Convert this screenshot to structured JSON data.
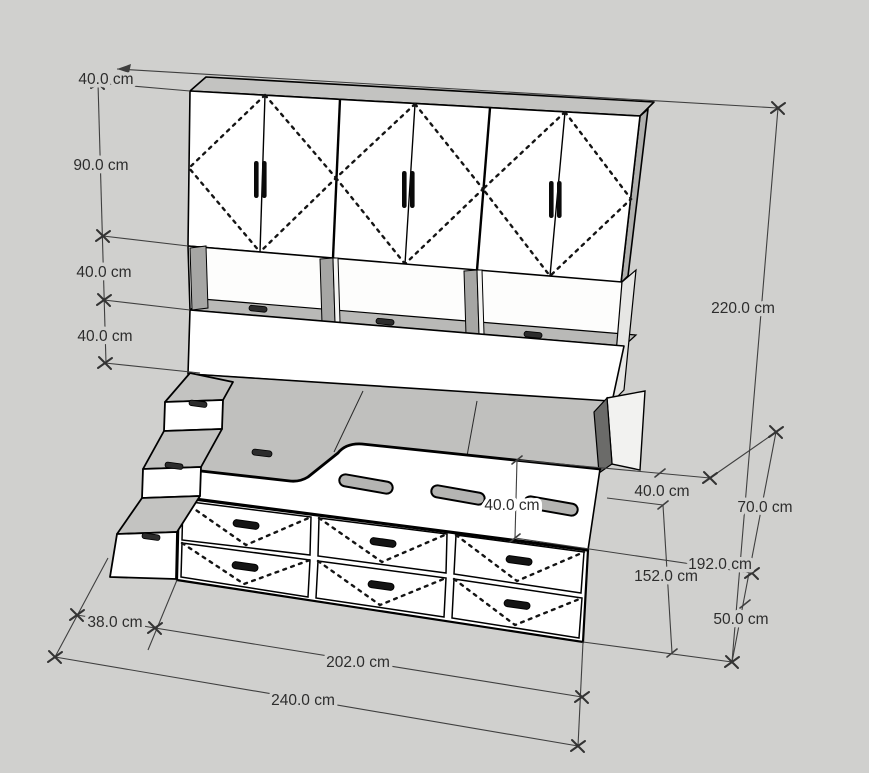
{
  "scene": {
    "description": "isometric CAD-style dimension drawing of a cabin bed with wardrobe, shelves, drawers and stairs",
    "unit": "cm",
    "background_color": "#d0d0ce",
    "face_color": "#ffffff",
    "top_face_color": "#c3c3c1",
    "shadow_color": "#a6a6a4",
    "dark_panel_color": "#6b6b69",
    "line_color": "#000000",
    "dimension_color": "#3f3f3f"
  },
  "dimensions": {
    "top_depth": "40.0 cm",
    "wardrobe_height": "90.0 cm",
    "shelf_row_height": "40.0 cm",
    "headboard_height": "40.0 cm",
    "total_height": "220.0 cm",
    "bed_rail_height": "40.0 cm",
    "bed_end_depth": "40.0 cm",
    "right_height_70": "70.0 cm",
    "bed_length_192": "192.0 cm",
    "bed_length_152": "152.0 cm",
    "right_height_50": "50.0 cm",
    "stairs_width": "38.0 cm",
    "drawers_length": "202.0 cm",
    "total_length": "240.0 cm"
  },
  "components": {
    "wardrobe_doors": 6,
    "wardrobe_door_pairs": 3,
    "open_shelf_compartments": 3,
    "shelf_lid_handles": 3,
    "bed_rail_slots": 3,
    "drawers": 6,
    "drawer_rows": 2,
    "drawer_columns": 3,
    "stair_steps": 3
  }
}
